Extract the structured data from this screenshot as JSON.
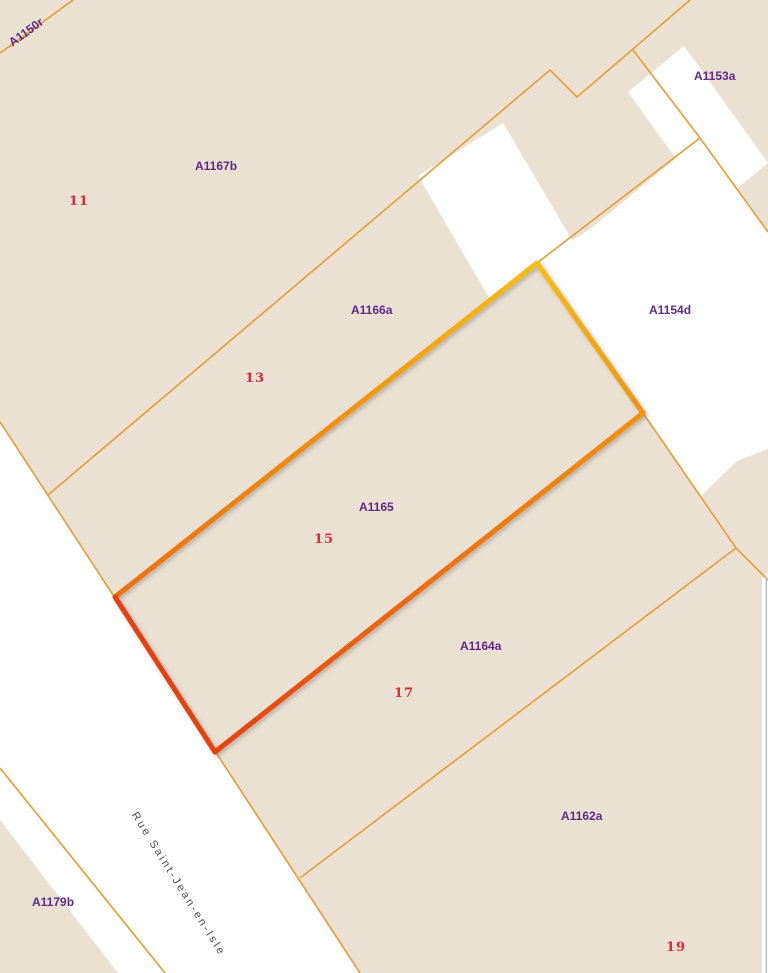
{
  "map": {
    "street_name": "Rue Saint-Jean-en-Isle",
    "selected_parcel": "A1165",
    "parcels": [
      {
        "id": "A1150r"
      },
      {
        "id": "A1167b"
      },
      {
        "id": "A1153a"
      },
      {
        "id": "A1166a"
      },
      {
        "id": "A1154d"
      },
      {
        "id": "A1165"
      },
      {
        "id": "A1164a"
      },
      {
        "id": "A1162a"
      },
      {
        "id": "A1179b"
      }
    ],
    "house_numbers": [
      "11",
      "13",
      "15",
      "17",
      "19"
    ],
    "colors": {
      "parcel_fill": "#EBE1D3",
      "road_fill": "#FFFFFF",
      "building_fill": "#FFFFFF",
      "boundary_line": "#E2A23B",
      "map_edge_line": "#BDBDBD",
      "parcel_label": "#5B2C88",
      "house_number": "#E02737",
      "street_label": "#4A4A55",
      "hl_yellow": "#F9BE12",
      "hl_orange": "#F1930F",
      "hl_deep_orange": "#EE6E0B",
      "hl_red": "#E8400C"
    }
  }
}
